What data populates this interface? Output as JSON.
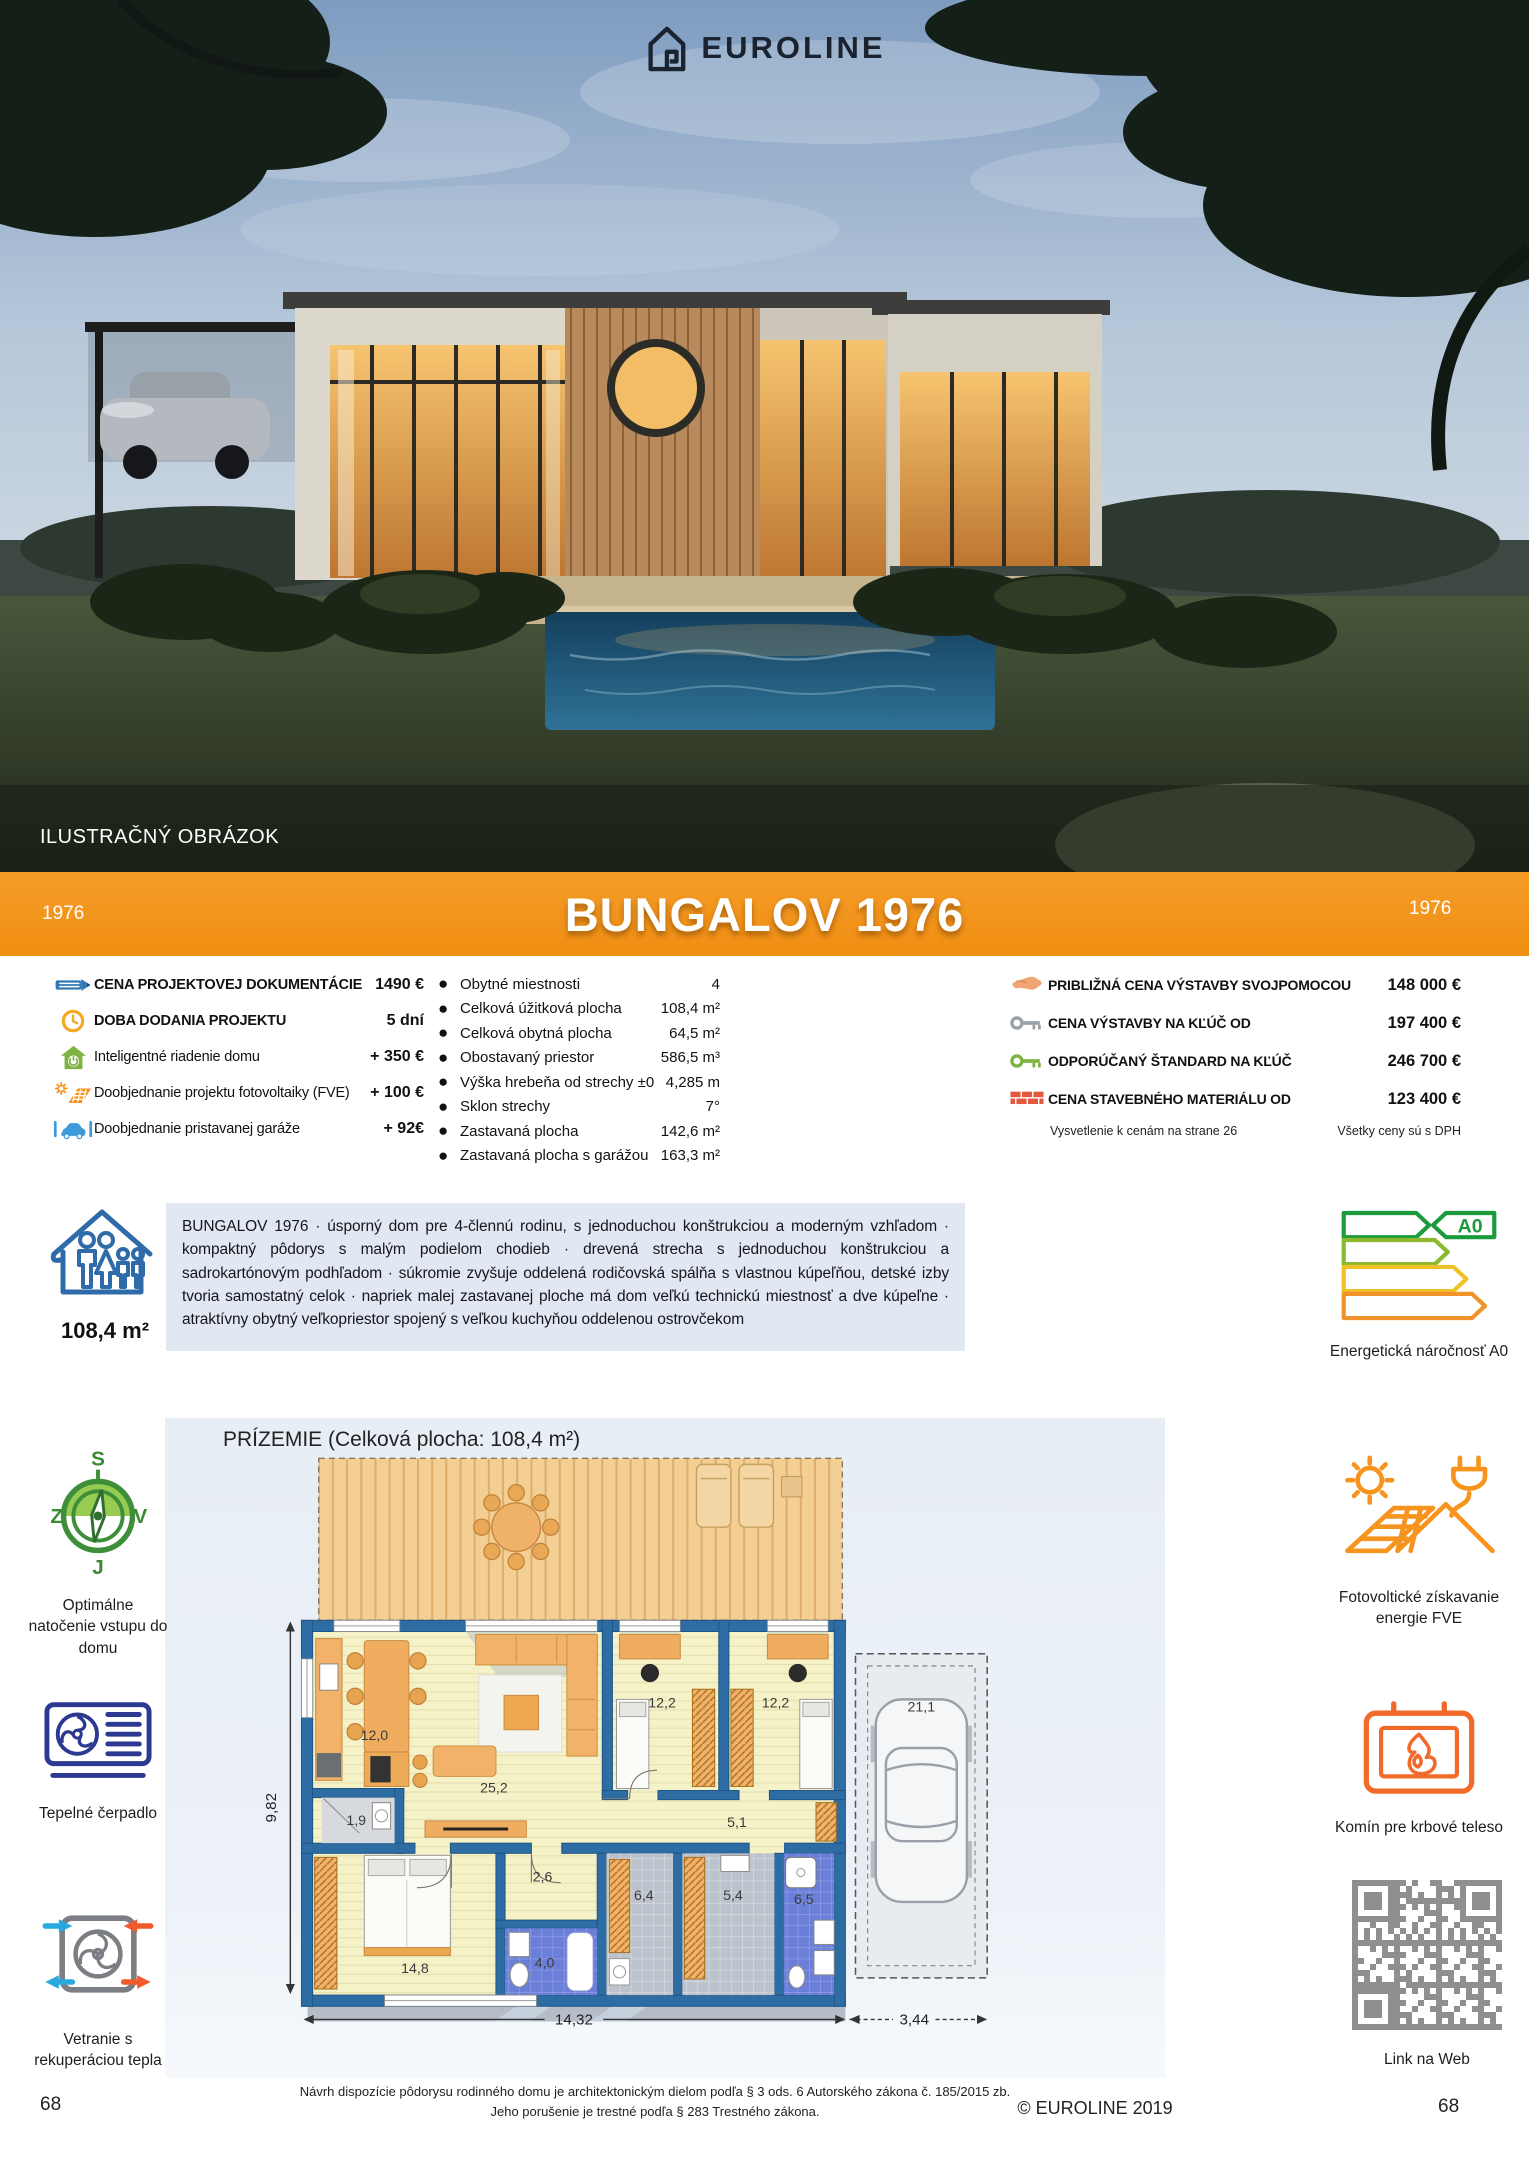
{
  "header": {
    "brand": "EUROLINE",
    "photo_caption": "ILUSTRAČNÝ OBRÁZOK"
  },
  "banner": {
    "year_left": "1976",
    "title": "BUNGALOV 1976",
    "year_right": "1976"
  },
  "specs_left": {
    "items": [
      {
        "icon": "pencil-icon",
        "label": "CENA PROJEKTOVEJ DOKUMENTÁCIE",
        "value": "1490 €"
      },
      {
        "icon": "clock-icon",
        "label": "DOBA DODANIA PROJEKTU",
        "value": "5 dní"
      },
      {
        "icon": "smart-home-icon",
        "label": "Inteligentné riadenie domu",
        "value": "+ 350 €"
      },
      {
        "icon": "solar-icon",
        "label": "Doobjednanie projektu fotovoltaiky (FVE)",
        "value": "+ 100 €"
      },
      {
        "icon": "garage-icon",
        "label": "Doobjednanie pristavanej garáže",
        "value": "+ 92€"
      }
    ]
  },
  "specs_middle": {
    "items": [
      {
        "label": "Obytné miestnosti",
        "value": "4"
      },
      {
        "label": "Celková úžitková plocha",
        "value": "108,4 m²"
      },
      {
        "label": "Celková obytná plocha",
        "value": "64,5 m²"
      },
      {
        "label": "Obostavaný priestor",
        "value": "586,5 m³"
      },
      {
        "label": "Výška hrebeňa od strechy ±0",
        "value": "4,285 m"
      },
      {
        "label": "Sklon strechy",
        "value": "7°"
      },
      {
        "label": "Zastavaná plocha",
        "value": "142,6 m²"
      },
      {
        "label": "Zastavaná plocha s garážou",
        "value": "163,3 m²"
      }
    ]
  },
  "specs_right": {
    "items": [
      {
        "icon": "hand-icon",
        "label": "PRIBLIŽNÁ CENA VÝSTAVBY SVOJPOMOCOU",
        "value": "148 000 €"
      },
      {
        "icon": "key-gray-icon",
        "label": "CENA VÝSTAVBY NA KĽÚČ OD",
        "value": "197 400 €"
      },
      {
        "icon": "key-green-icon",
        "label": "ODPORÚČANÝ ŠTANDARD NA KĽÚČ",
        "value": "246 700 €"
      },
      {
        "icon": "bricks-icon",
        "label": "CENA STAVEBNÉHO MATERIÁLU OD",
        "value": "123 400 €"
      }
    ],
    "note_left": "Vysvetlenie k cenám na strane 26",
    "note_right": "Všetky ceny sú s DPH"
  },
  "description": {
    "area": "108,4 m²",
    "text": "BUNGALOV 1976 · úsporný dom pre 4-člennú rodinu, s jednoduchou konštrukciou a moderným vzhľadom · kompaktný pôdorys s malým podielom chodieb · drevená strecha s jednoduchou konštrukciou a sadrokartónovým podhľadom · súkromie zvyšuje oddelená rodičovská spálňa s vlastnou kúpeľňou, detské izby tvoria samostatný celok · napriek malej zastavanej ploche má dom veľkú technickú miestnosť a dve kúpeľne · atraktívny obytný veľkopriestor spojený s veľkou kuchyňou oddelenou ostrovčekom"
  },
  "sidebar_left": {
    "compass_label": "Optimálne natočenie vstupu do domu",
    "compass_n": "S",
    "compass_w": "Z",
    "compass_e": "V",
    "compass_s": "J",
    "heatpump_label": "Tepelné čerpadlo",
    "ventilation_label": "Vetranie s rekuperáciou tepla"
  },
  "sidebar_right": {
    "energy_label": "Energetická náročnosť A0",
    "energy_badge": "A0",
    "fve_label": "Fotovoltické získavanie energie FVE",
    "fireplace_label": "Komín pre krbové teleso",
    "qr_label": "Link na Web"
  },
  "floorplan": {
    "title": "PRÍZEMIE (Celková plocha: 108,4 m²)",
    "rooms": {
      "kitchen": "12,0",
      "living": "25,2",
      "wc": "1,9",
      "hall": "2,6",
      "kid1": "12,2",
      "kid2": "12,2",
      "corridor": "5,1",
      "bedroom": "14,8",
      "bath1": "4,0",
      "tech": "6,4",
      "laundry": "5,4",
      "bath2": "6,5",
      "garage": "21,1"
    },
    "dims": {
      "height": "9,82",
      "width": "14,32",
      "garage_width": "3,44"
    }
  },
  "footer": {
    "disclaimer_line1": "Návrh dispozície pôdorysu rodinného domu je architektonickým dielom podľa § 3 ods. 6 Autorského zákona č. 185/2015 zb.",
    "disclaimer_line2": "Jeho porušenie je trestné podľa § 283 Trestného zákona.",
    "copyright": "© EUROLINE 2019",
    "page_left": "68",
    "page_right": "68"
  }
}
